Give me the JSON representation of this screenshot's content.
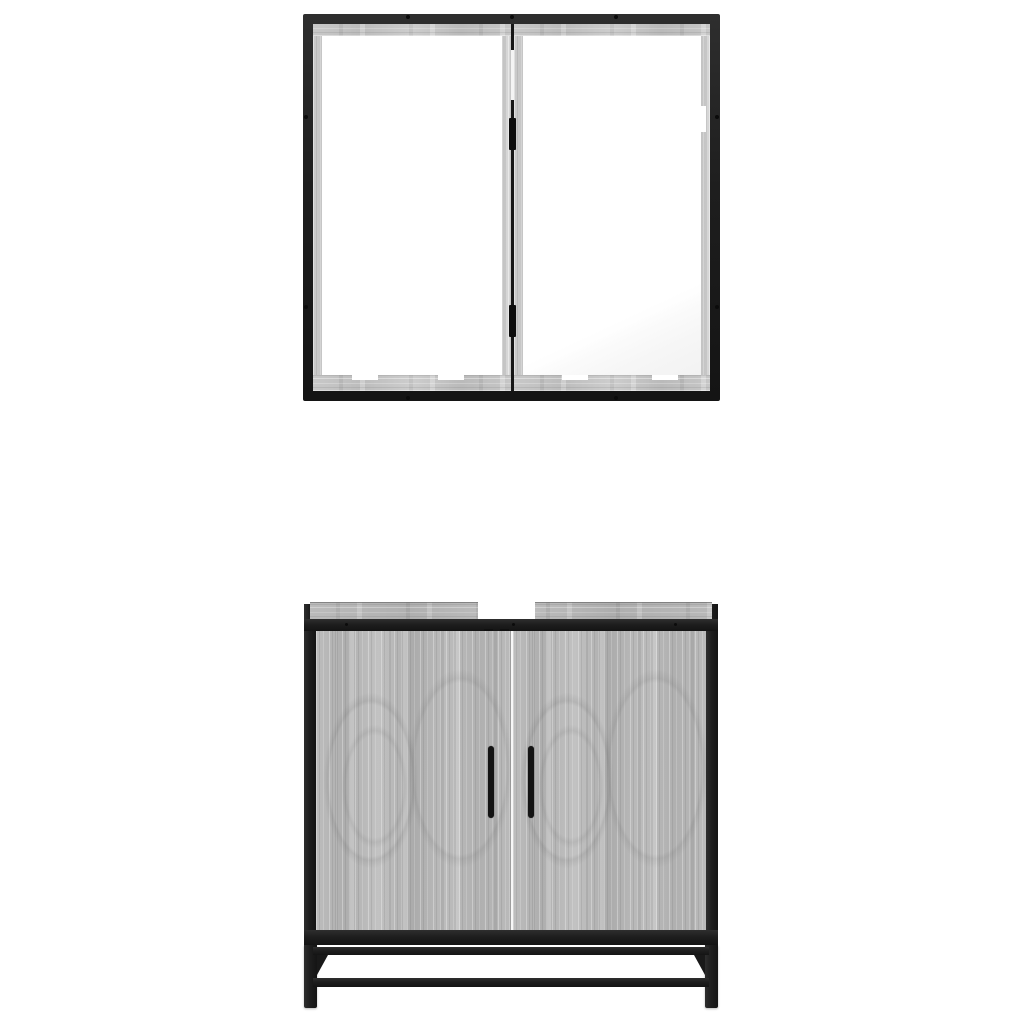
{
  "scene": {
    "background": "#ffffff",
    "subject": "two-piece-bathroom-furniture-set",
    "pieces": [
      {
        "name": "mirror-cabinet",
        "doors": 2,
        "mirrors": 2,
        "mirror_clips_per_door": 2
      },
      {
        "name": "washbasin-cabinet",
        "doors": 2,
        "handles": 2,
        "legs": 2,
        "crossbars": 2,
        "plumbing_notch": 1
      }
    ]
  },
  "colors": {
    "background": "#ffffff",
    "metal": "#1e1e1e",
    "metal_dark": "#141414",
    "metal_light": "#2e2e2e",
    "wood_base": "#b6b6b6",
    "wood_light": "#d4d4d4",
    "wood_dark": "#989898",
    "mirror_white": "#fefefe",
    "mirror_shade": "#e6e6e6",
    "handle": "#131313",
    "notch": "#ffffff"
  }
}
